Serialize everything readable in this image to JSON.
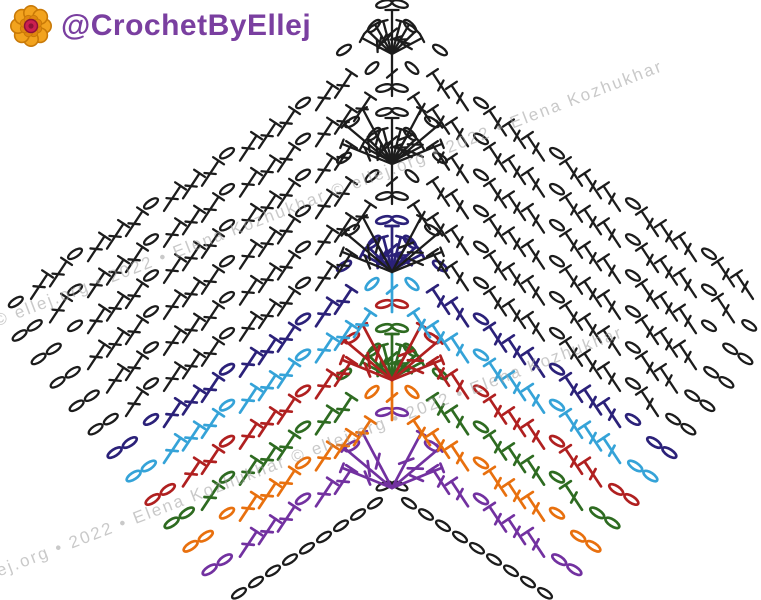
{
  "page": {
    "width": 761,
    "height": 600,
    "background": "#ffffff"
  },
  "logo": {
    "icon": "flower-icon",
    "handle": "@CrochetByEllej",
    "text_color": "#7a3fa0",
    "flower_colors": {
      "petal": "#f2a31e",
      "petal_outline": "#c97a08",
      "inner_ring": "#e0860f",
      "center": "#cc2050",
      "center_dark": "#8e1238"
    }
  },
  "watermark": {
    "text": "© ellej.org • 2022 • Elena Kozhukhar",
    "color": "#9d9d9d",
    "opacity": 0.55,
    "angle_deg": -21,
    "instances": [
      {
        "x": -5,
        "y": 312,
        "repeat": 2
      },
      {
        "x": -45,
        "y": 578,
        "repeat": 2
      }
    ]
  },
  "chart_data": {
    "type": "crochet-chevron-diagram",
    "pattern_name": "Chevron / ripple stitch crochet chart",
    "repeat_structure": "3-row repeat: shell (fan) row + 2 double-crochet rows, worked over a chevron with center peak",
    "stitch_legend": [
      {
        "symbol": "oval",
        "name": "chain (ch)"
      },
      {
        "symbol": "T-with-crossbar",
        "name": "double crochet (dc)"
      },
      {
        "symbol": "fan-shell",
        "name": "dc shell worked into peak point with ch-2 at apex"
      },
      {
        "symbol": "center-dc",
        "name": "peak dc flanked by chains"
      },
      {
        "symbol": "v-legs",
        "name": "dc group converging into peak point below"
      }
    ],
    "rows_bottom_to_top": [
      {
        "row": 0,
        "name": "foundation-chain",
        "color_name": "black",
        "color": "#1c1c1c",
        "peak": "chain-pair"
      },
      {
        "row": 1,
        "name": "row-1",
        "color_name": "purple",
        "color": "#7231a0",
        "peak": "v-legs"
      },
      {
        "row": 2,
        "name": "row-2",
        "color_name": "orange",
        "color": "#e8700e",
        "peak": "center-dc"
      },
      {
        "row": 3,
        "name": "row-3",
        "color_name": "green",
        "color": "#2e6b21",
        "peak": "fan-shell"
      },
      {
        "row": 4,
        "name": "row-4",
        "color_name": "red",
        "color": "#b02020",
        "peak": "v-legs"
      },
      {
        "row": 5,
        "name": "row-5",
        "color_name": "cyan",
        "color": "#35a3d8",
        "peak": "center-dc"
      },
      {
        "row": 6,
        "name": "row-6",
        "color_name": "navy",
        "color": "#2b2179",
        "peak": "fan-shell"
      },
      {
        "row": 7,
        "name": "row-7",
        "color_name": "black",
        "color": "#1c1c1c",
        "peak": "v-legs"
      },
      {
        "row": 8,
        "name": "row-8",
        "color_name": "black",
        "color": "#1c1c1c",
        "peak": "center-dc"
      },
      {
        "row": 9,
        "name": "row-9",
        "color_name": "black",
        "color": "#1c1c1c",
        "peak": "fan-shell"
      },
      {
        "row": 10,
        "name": "row-10",
        "color_name": "black",
        "color": "#1c1c1c",
        "peak": "v-legs"
      },
      {
        "row": 11,
        "name": "row-11",
        "color_name": "black",
        "color": "#1c1c1c",
        "peak": "center-dc"
      },
      {
        "row": 12,
        "name": "row-12",
        "color_name": "black",
        "color": "#1c1c1c",
        "peak": "fan-shell"
      }
    ],
    "layout": {
      "peak_x": 392,
      "foundation_peak_y": 492,
      "row_spacing_px": 36,
      "wing_slope_deg": 33.5,
      "stitch_pitch_px": 19,
      "left_corner": [
        10,
        295
      ],
      "bottom_left_end": [
        229,
        585
      ]
    }
  }
}
